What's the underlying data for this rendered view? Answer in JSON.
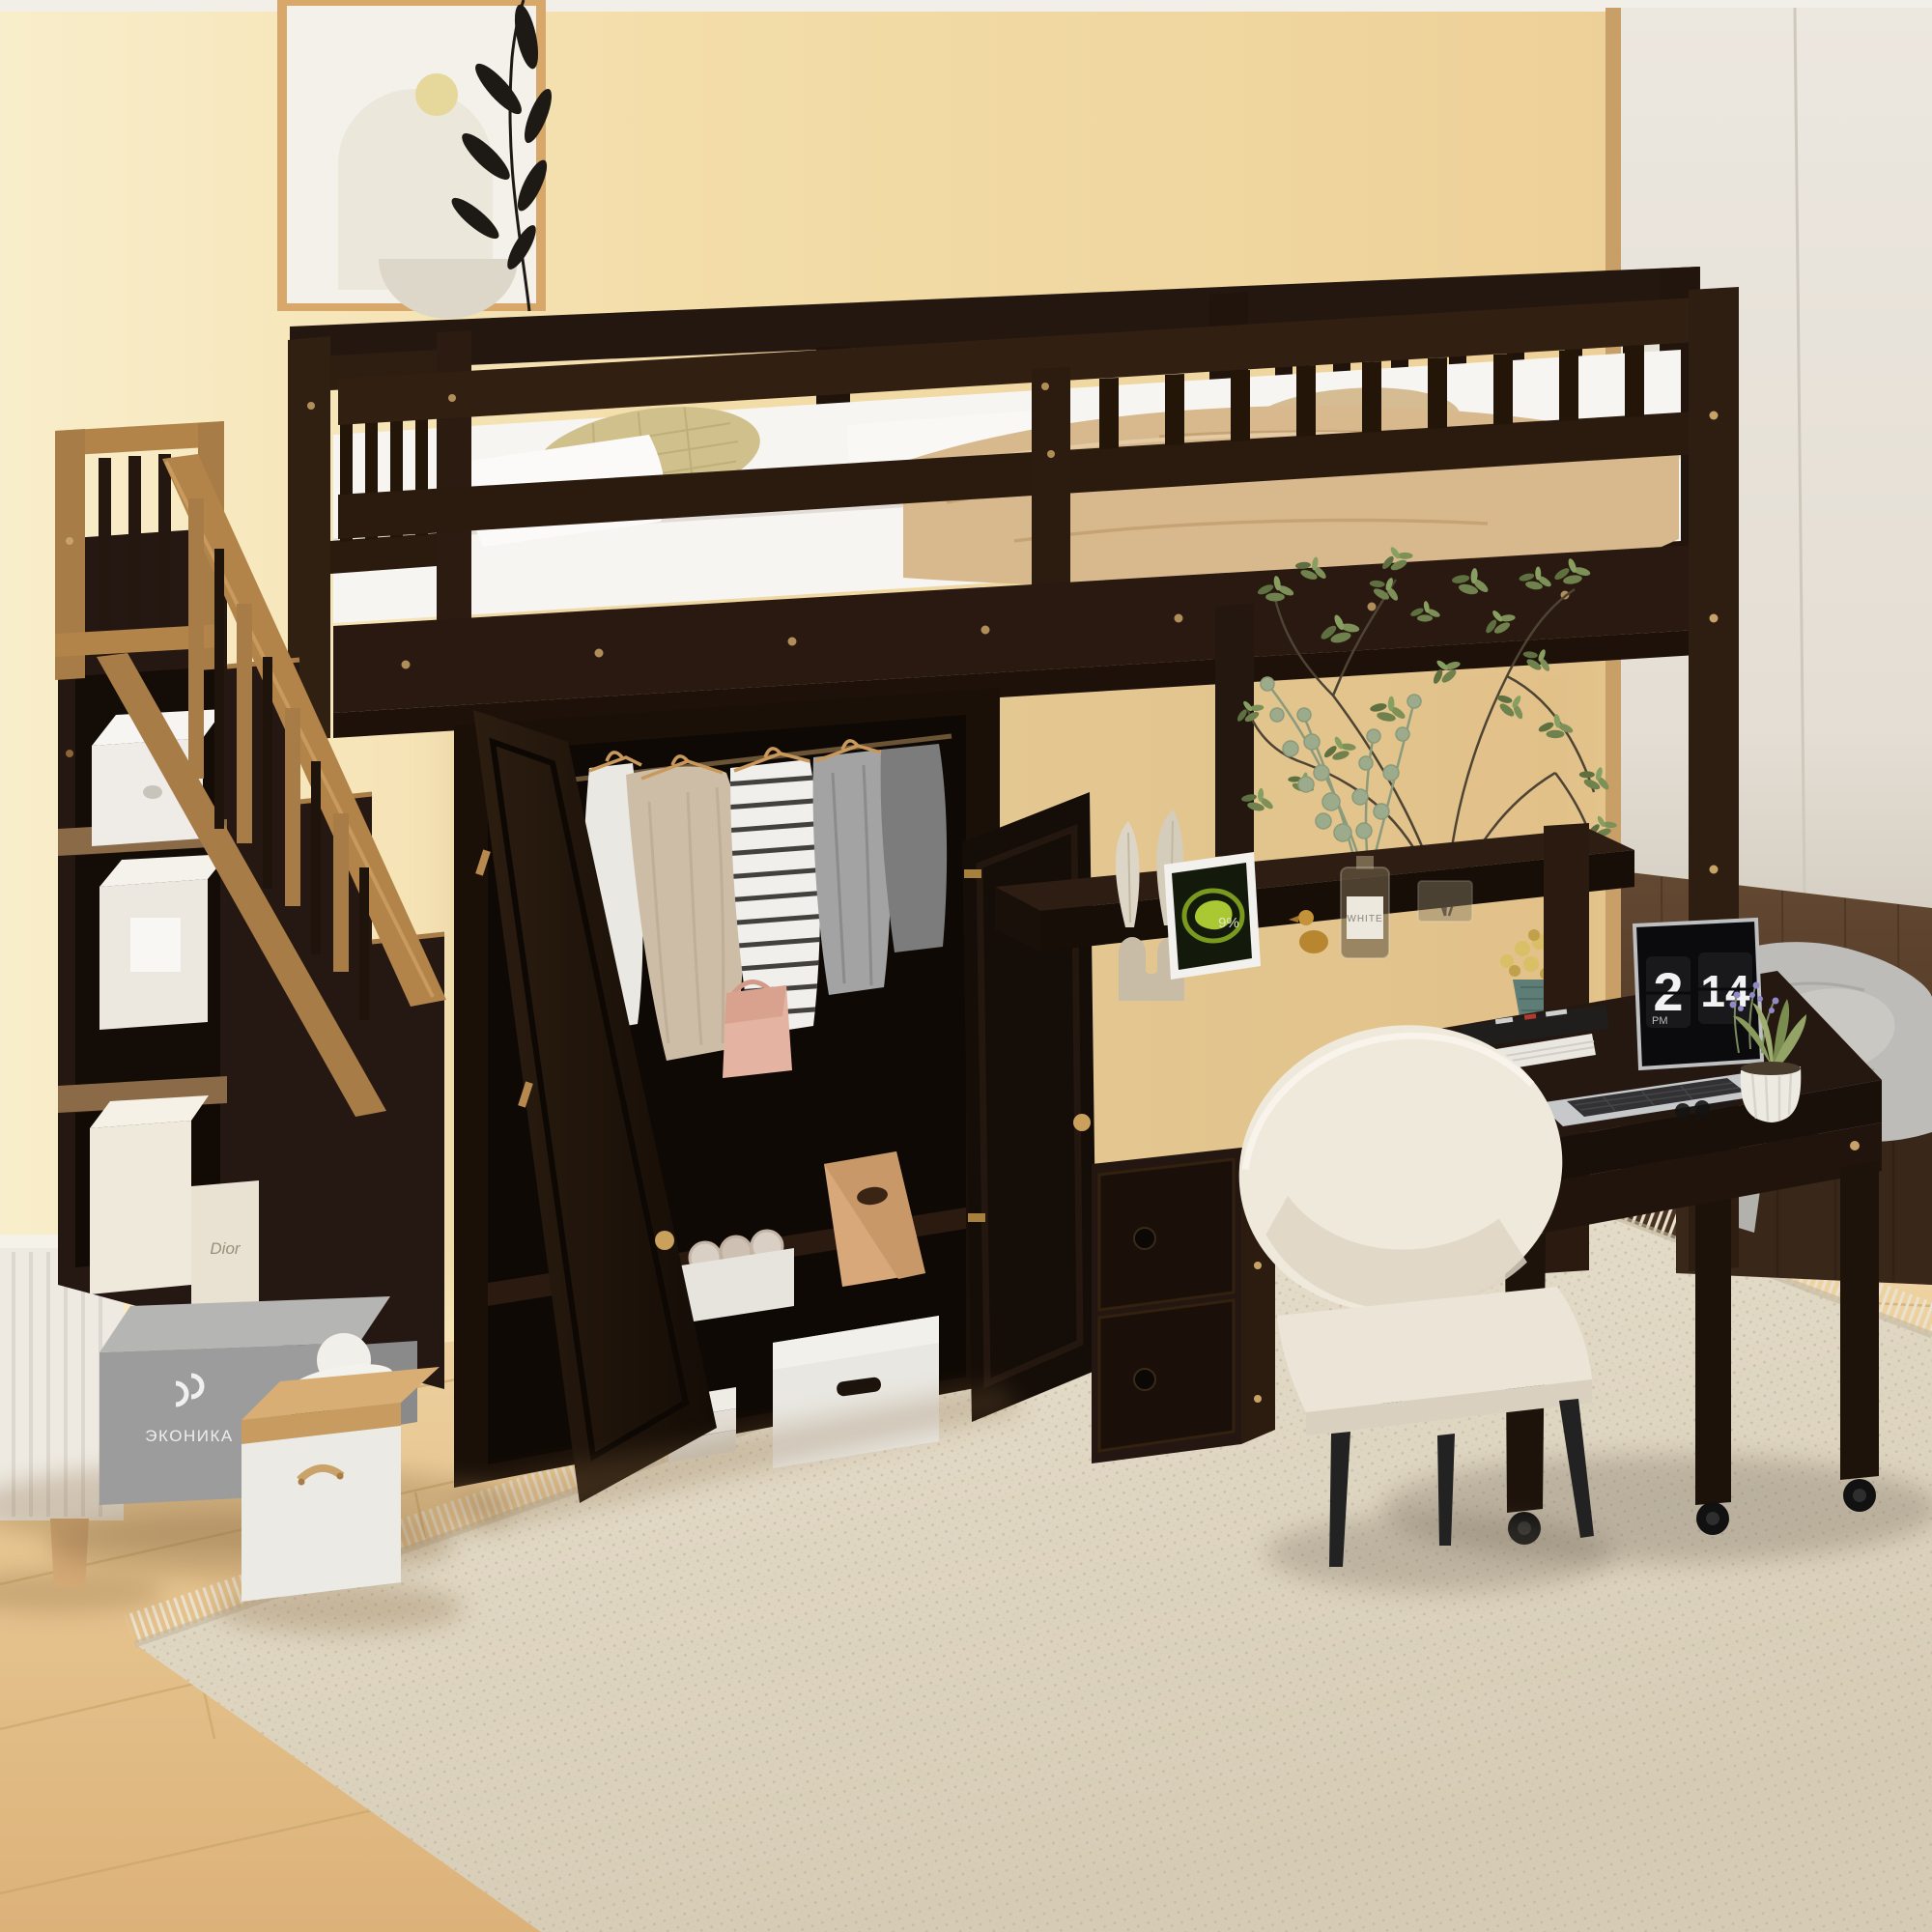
{
  "scene": {
    "description": "Product photo: espresso loft bed with staircase storage shelves, built-in wardrobe with hanging clothes, under-bed desk, rolling desk with laptop, cream chair, beige room with area rug",
    "colors": {
      "wall": "#f3dda9",
      "wall_light": "#f9eecb",
      "ceiling": "#f2efe9",
      "closet_white": "#e9e4dc",
      "walnut_panel": "#57402c",
      "floor_wood": "#ecd09e",
      "floor_seam": "#c9a66b",
      "rug_cream": "#e3dac7",
      "espresso_frame": "#2a1a10",
      "gold_rail": "#b08449",
      "mattress_white": "#f7f5f1",
      "blanket_tan": "#d8b98e",
      "pillow_olive": "#cfc08c",
      "chair_cream": "#efe9dc",
      "laptop_silver": "#c6c8ca",
      "plant_green": "#6f814d",
      "eucalyptus_green": "#9cab8c",
      "paper_bag_tan": "#d8a87a",
      "shoebox_gray": "#9c9c9c",
      "flowerpot_teal": "#5d7d76"
    },
    "devices": {
      "laptop_clock": {
        "hour": "2",
        "minute": "14",
        "meridiem": "PM"
      },
      "tablet_battery": "9%"
    },
    "storage": {
      "box_label_dior": "Dior",
      "shoebox_logo": "ЭКОНИКА",
      "diffuser_label": "WHITE"
    }
  }
}
